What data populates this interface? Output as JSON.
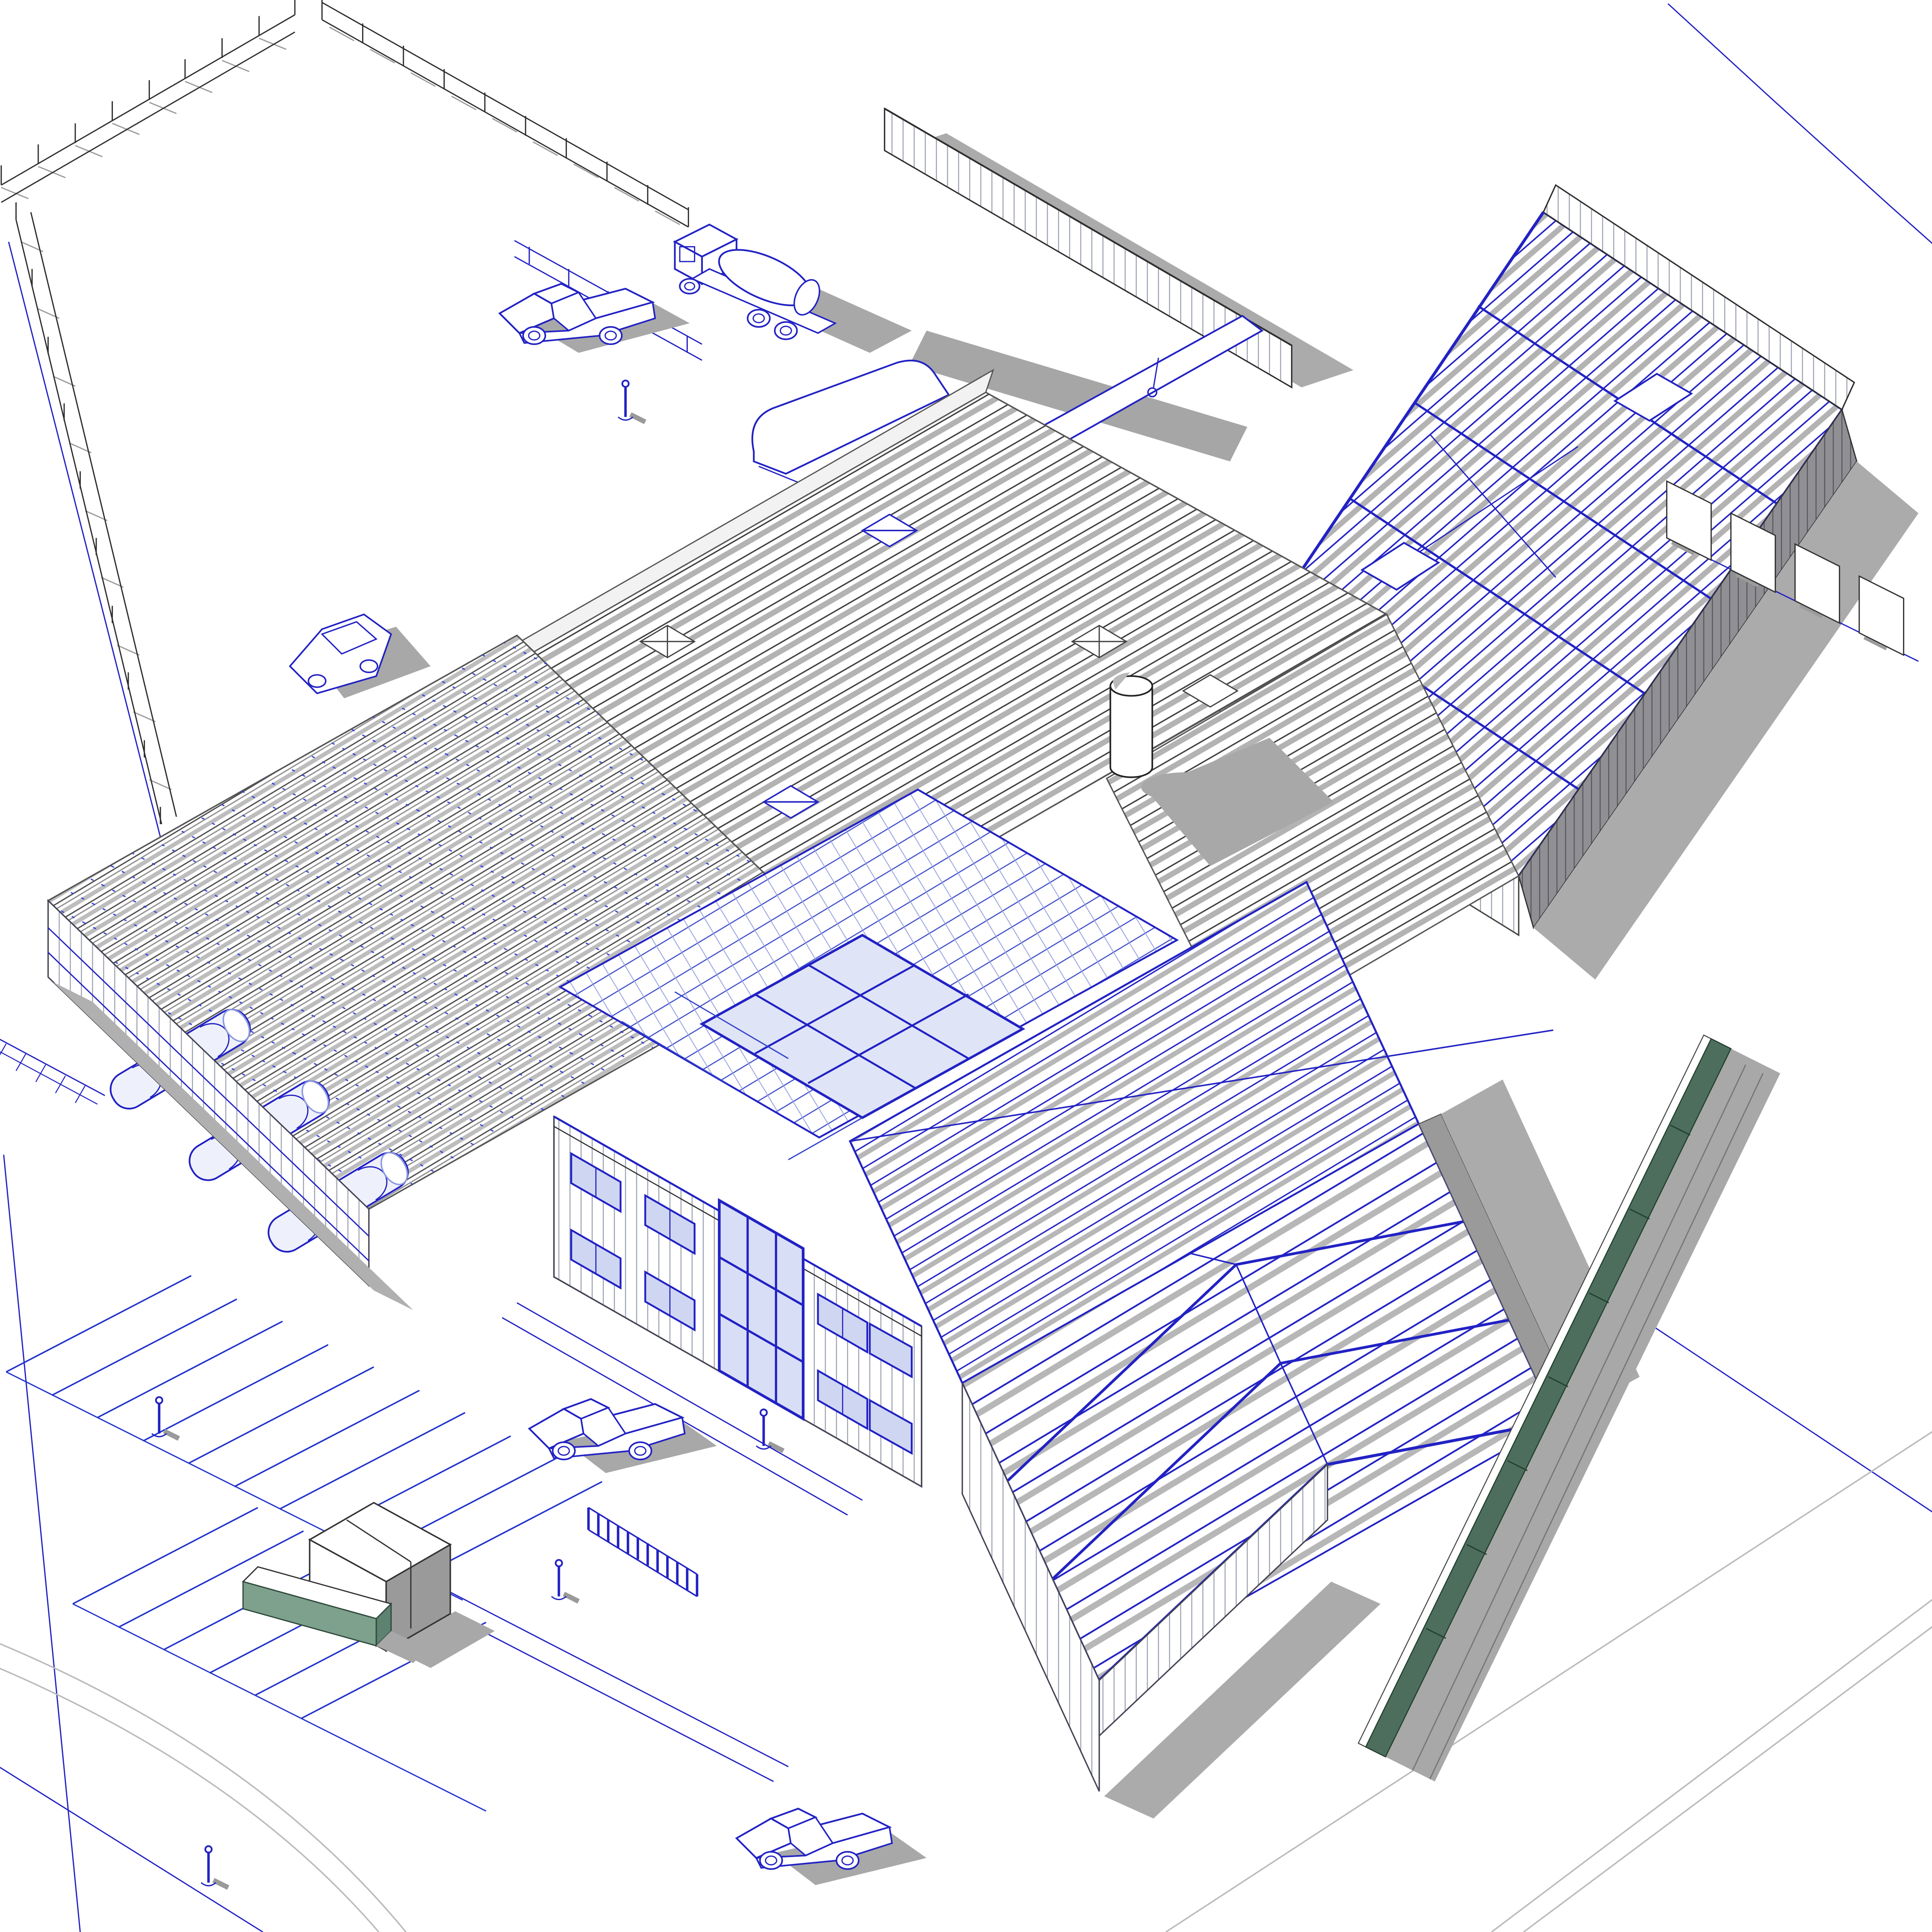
{
  "view": {
    "type": "3d-axonometric-model-view",
    "description": "Isometric BIM view of an industrial building complex under construction with exposed blue steel framing, gray roof purlins and cast shadows",
    "background": "#ffffff"
  },
  "palette": {
    "background": "#ffffff",
    "wire_blue": "#2222c4",
    "wire_blue_soft": "#8d99e0",
    "line_dark": "#2e2e2e",
    "line_gray": "#777777",
    "shadow": "#a8a8a8",
    "shadow_dark": "#979797",
    "wall_shadow_clad": "#8f8f94",
    "glass": "#d8def5",
    "glass_roof": "#e6eafa",
    "green_fence": "#4d6e5d",
    "green_fence_edge": "#23402f",
    "green_wall": "#7da18c",
    "door_gray": "#8e8e8e",
    "curb_gray": "#bbbbbb"
  },
  "scene": {
    "site": [
      {
        "name": "perimeter-fence-northwest",
        "kind": "fence"
      },
      {
        "name": "perimeter-fence-north",
        "kind": "fence"
      },
      {
        "name": "perimeter-fence-west",
        "kind": "fence"
      },
      {
        "name": "site-hoarding-wall",
        "kind": "wall"
      },
      {
        "name": "boundary-line-east",
        "kind": "property-line"
      },
      {
        "name": "boundary-line-west",
        "kind": "property-line"
      },
      {
        "name": "parking-striping-southwest",
        "kind": "parking"
      },
      {
        "name": "green-screen-fence",
        "kind": "fence"
      },
      {
        "name": "green-landscape-wall",
        "kind": "wall"
      },
      {
        "name": "waste-enclosure",
        "kind": "structure"
      },
      {
        "name": "courtyard-gate",
        "kind": "gate"
      },
      {
        "name": "security-fence-east",
        "kind": "fence"
      }
    ],
    "building_wings": [
      {
        "name": "steel-frame-hall-northeast",
        "structure": "open blue steel frame with purlins and bracing"
      },
      {
        "name": "central-hall-roof",
        "structure": "gray purlin grid with square skylight curbs"
      },
      {
        "name": "skylight-hall-west",
        "structure": "gray lattice trusses with barrel-vault skylights"
      },
      {
        "name": "office-core",
        "structure": "blue framing with glazed atrium roof"
      },
      {
        "name": "office-block",
        "structure": "two-storey clad facade, blue windows, glazed entrance"
      },
      {
        "name": "steel-frame-hall-southeast",
        "structure": "open blue portal frames, partially clad"
      }
    ],
    "equipment": [
      {
        "name": "concrete-mixer-truck"
      },
      {
        "name": "tracked-crane-excavator",
        "detail": "long boom casting diagonal shadow"
      },
      {
        "name": "pickup-truck-northwest"
      },
      {
        "name": "pickup-truck-courtyard"
      },
      {
        "name": "pickup-truck-south"
      },
      {
        "name": "parked-sedan"
      },
      {
        "name": "storage-silo"
      }
    ],
    "people_count": 6
  }
}
